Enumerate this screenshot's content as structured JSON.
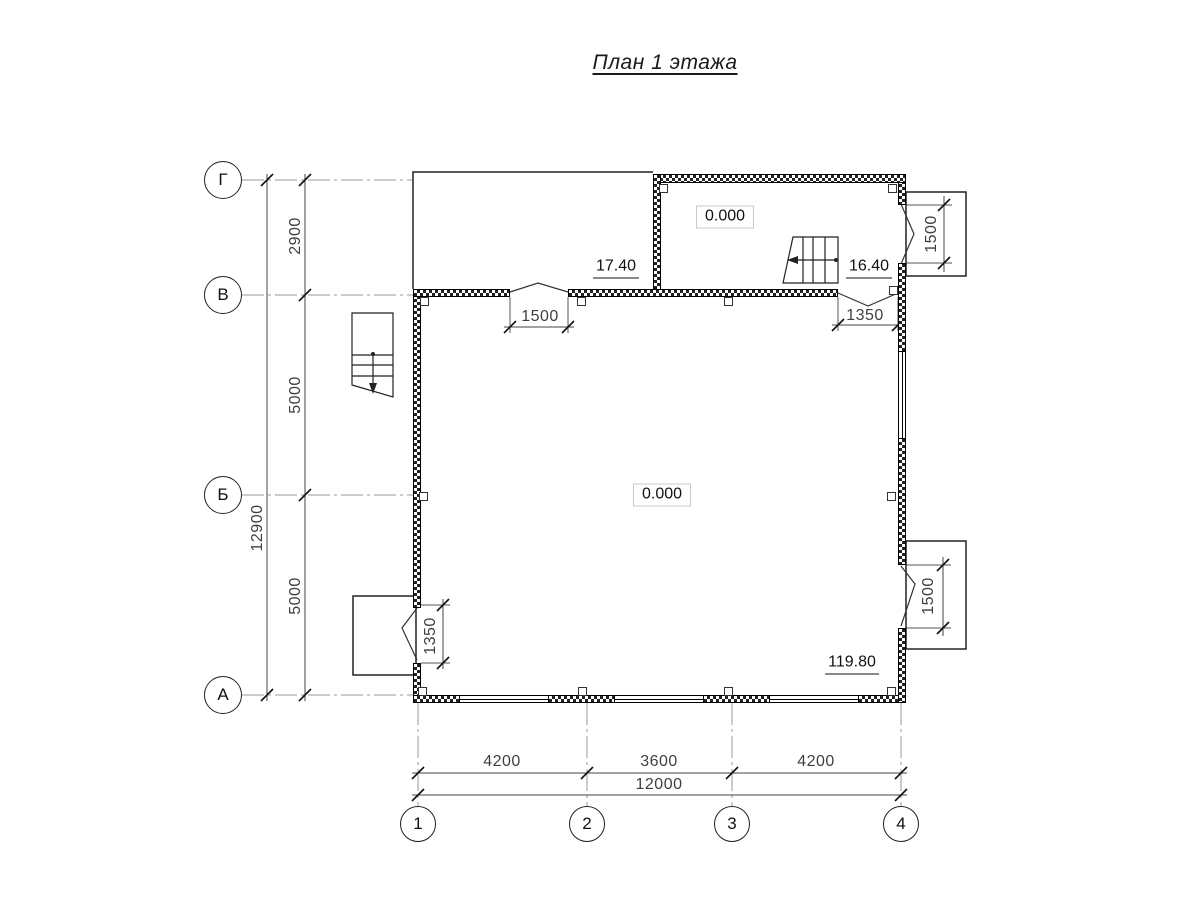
{
  "title": "План 1 этажа",
  "grid": {
    "row_axes": [
      {
        "label": "Г"
      },
      {
        "label": "В"
      },
      {
        "label": "Б"
      },
      {
        "label": "А"
      }
    ],
    "col_axes": [
      {
        "label": "1"
      },
      {
        "label": "2"
      },
      {
        "label": "3"
      },
      {
        "label": "4"
      }
    ]
  },
  "dimensions": {
    "left_segments": [
      "2900",
      "5000",
      "5000"
    ],
    "left_total": "12900",
    "bottom_segments": [
      "4200",
      "3600",
      "4200"
    ],
    "bottom_total": "12000",
    "top_door_width": "1500",
    "right_door_width": "1350",
    "left_door_width": "1350",
    "top_right_window": "1500",
    "bottom_right_window": "1500"
  },
  "levels": {
    "upper_room": "0.000",
    "main_room": "0.000",
    "mark_17": "17.40",
    "mark_16": "16.40",
    "mark_119": "119.80"
  }
}
